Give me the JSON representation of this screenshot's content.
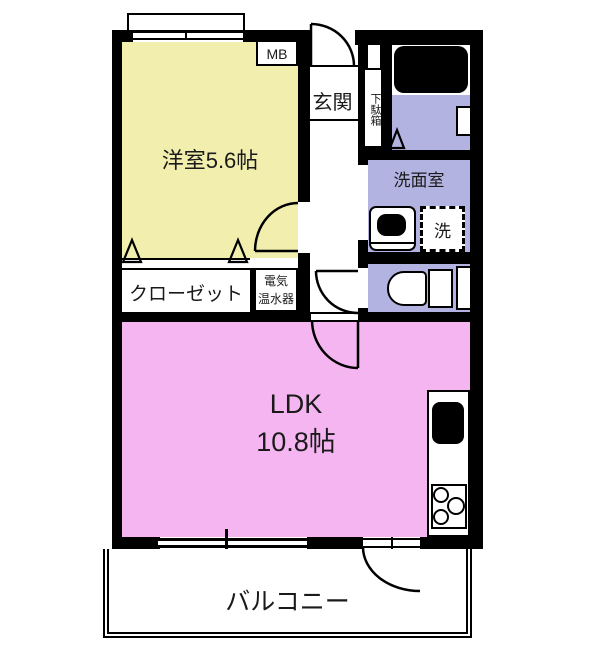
{
  "plan": {
    "rooms": {
      "western_room": {
        "label": "洋室5.6帖"
      },
      "entrance": {
        "label": "玄関"
      },
      "shoe_cabinet": {
        "label": "下駄箱"
      },
      "meter_box": {
        "label": "MB"
      },
      "washroom": {
        "label": "洗面室"
      },
      "washing_machine": {
        "label": "洗"
      },
      "closet": {
        "label": "クローゼット"
      },
      "water_heater": {
        "line1": "電気",
        "line2": "温水器"
      },
      "ldk": {
        "label": "LDK",
        "size": "10.8帖"
      },
      "balcony": {
        "label": "バルコニー"
      }
    },
    "colors": {
      "western_room": "#F1EEAE",
      "ldk": "#F4B5F0",
      "wet_area": "#B3B3E2",
      "wall": "#000000",
      "background": "#FFFFFF"
    }
  }
}
